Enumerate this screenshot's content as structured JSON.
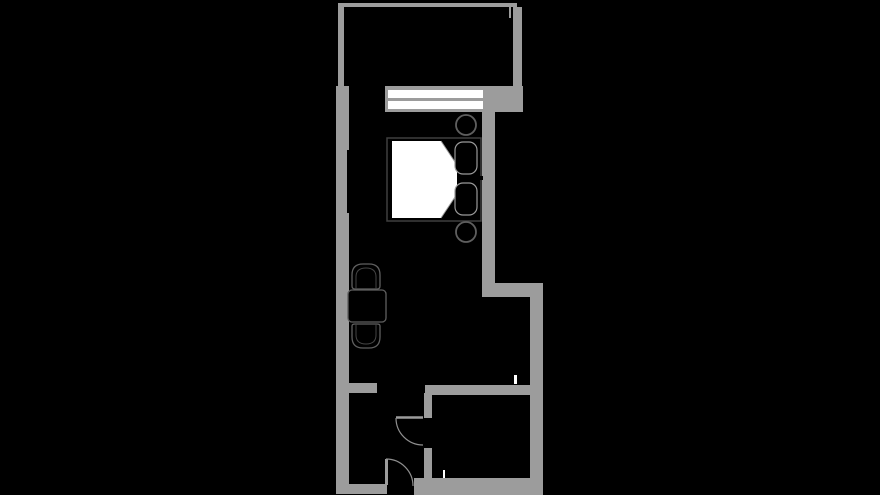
{
  "app": {
    "kind": "floor-plan-image",
    "description": "studio-apartment-floor-plan-on-black"
  },
  "colors": {
    "bg": "#000000",
    "wall": "#9c9c9c",
    "white": "#ffffff",
    "bedStroke": "#3f3f3f",
    "pillowStroke": "#9a9a9a",
    "fold": "#9a9a9a",
    "furn": "#5f5f5f",
    "furnDim": "#454545",
    "door": "#8f8f8f"
  },
  "floorplan": {
    "canvas": {
      "width": 880,
      "height": 495
    },
    "rooms": [
      {
        "name": "balcony",
        "bounds": [
          344,
          7,
          169,
          79
        ]
      },
      {
        "name": "main-room",
        "bounds": [
          349,
          112,
          133,
          271
        ]
      },
      {
        "name": "entry-hall",
        "bounds": [
          349,
          393,
          75,
          91
        ]
      },
      {
        "name": "bathroom",
        "bounds": [
          432,
          395,
          98,
          83
        ]
      }
    ],
    "elements": [
      {
        "name": "room-balcony",
        "type": "rect",
        "x": 344,
        "y": 7,
        "w": 169,
        "h": 79,
        "fill": "bg"
      },
      {
        "name": "room-main",
        "type": "rect",
        "x": 349,
        "y": 112,
        "w": 133,
        "h": 271,
        "fill": "bg"
      },
      {
        "name": "room-entry-hall",
        "type": "rect",
        "x": 349,
        "y": 393,
        "w": 75,
        "h": 91,
        "fill": "bg"
      },
      {
        "name": "room-bathroom",
        "type": "rect",
        "x": 432,
        "y": 395,
        "w": 98,
        "h": 83,
        "fill": "bg"
      },
      {
        "name": "wall-balcony-top-rail",
        "type": "rect",
        "x": 338,
        "y": 3,
        "w": 179,
        "h": 4,
        "fill": "wall"
      },
      {
        "name": "wall-left-upper",
        "type": "rect",
        "x": 338,
        "y": 7,
        "w": 6,
        "h": 79,
        "fill": "wall"
      },
      {
        "name": "wall-left-main",
        "type": "rect",
        "x": 336,
        "y": 86,
        "w": 13,
        "h": 408,
        "fill": "wall"
      },
      {
        "name": "wall-window-band",
        "type": "rect",
        "x": 385,
        "y": 86,
        "w": 138,
        "h": 26,
        "fill": "wall"
      },
      {
        "name": "wall-balcony-right",
        "type": "rect",
        "x": 513,
        "y": 7,
        "w": 9,
        "h": 105,
        "fill": "wall"
      },
      {
        "name": "wall-balcony-right-return",
        "type": "rect",
        "x": 509,
        "y": 7,
        "w": 2,
        "h": 11,
        "fill": "wall"
      },
      {
        "name": "wall-main-right",
        "type": "rect",
        "x": 482,
        "y": 110,
        "w": 13,
        "h": 187,
        "fill": "wall"
      },
      {
        "name": "wall-right-step",
        "type": "rect",
        "x": 482,
        "y": 283,
        "w": 61,
        "h": 14,
        "fill": "wall"
      },
      {
        "name": "wall-lower-right",
        "type": "rect",
        "x": 530,
        "y": 283,
        "w": 13,
        "h": 212,
        "fill": "wall"
      },
      {
        "name": "wall-bathroom-top",
        "type": "rect",
        "x": 425,
        "y": 385,
        "w": 108,
        "h": 10,
        "fill": "wall"
      },
      {
        "name": "wall-bathroom-left-upper",
        "type": "rect",
        "x": 424,
        "y": 393,
        "w": 8,
        "h": 25,
        "fill": "wall"
      },
      {
        "name": "wall-bathroom-left-lower",
        "type": "rect",
        "x": 424,
        "y": 448,
        "w": 8,
        "h": 30,
        "fill": "wall"
      },
      {
        "name": "wall-hall-stub",
        "type": "rect",
        "x": 349,
        "y": 383,
        "w": 28,
        "h": 10,
        "fill": "wall"
      },
      {
        "name": "wall-bottom-left",
        "type": "rect",
        "x": 336,
        "y": 484,
        "w": 51,
        "h": 10,
        "fill": "wall"
      },
      {
        "name": "wall-bottom-right",
        "type": "rect",
        "x": 414,
        "y": 478,
        "w": 129,
        "h": 17,
        "fill": "wall"
      },
      {
        "name": "window-glazing-outer",
        "type": "rect",
        "x": 388,
        "y": 90,
        "w": 95,
        "h": 8,
        "fill": "white"
      },
      {
        "name": "window-glazing-inner",
        "type": "rect",
        "x": 388,
        "y": 101,
        "w": 95,
        "h": 8,
        "fill": "white"
      },
      {
        "name": "wardrobe-recess",
        "type": "rect",
        "x": 347,
        "y": 150,
        "w": 3,
        "h": 63,
        "fill": "bg"
      },
      {
        "name": "bed-frame",
        "type": "rect",
        "x": 387,
        "y": 138,
        "w": 94,
        "h": 83,
        "fill": "bg",
        "stroke": "bedStroke",
        "sw": 1.5
      },
      {
        "name": "bed-mattress",
        "type": "polygon",
        "points": "392,141 441,141 457,165 457,194 441,218 392,218",
        "fill": "white"
      },
      {
        "name": "bed-sheet-fold-top",
        "type": "line",
        "x1": 441,
        "y1": 141,
        "x2": 457,
        "y2": 165,
        "stroke": "fold",
        "sw": 1
      },
      {
        "name": "bed-sheet-fold-bottom",
        "type": "line",
        "x1": 457,
        "y1": 194,
        "x2": 441,
        "y2": 218,
        "stroke": "fold",
        "sw": 1
      },
      {
        "name": "bed-pillow-top",
        "type": "rect",
        "x": 455,
        "y": 142,
        "w": 22,
        "h": 32,
        "rx": 8,
        "fill": "bg",
        "stroke": "pillowStroke",
        "sw": 1.2
      },
      {
        "name": "bed-pillow-bottom",
        "type": "rect",
        "x": 455,
        "y": 183,
        "w": 22,
        "h": 32,
        "rx": 8,
        "fill": "bg",
        "stroke": "pillowStroke",
        "sw": 1.2
      },
      {
        "name": "bed-headboard-notch",
        "type": "rect",
        "x": 479,
        "y": 176,
        "w": 4,
        "h": 4,
        "fill": "bg"
      },
      {
        "name": "nightstand-top",
        "type": "circle",
        "cx": 466,
        "cy": 125,
        "r": 10,
        "fill": "bg",
        "stroke": "furn",
        "sw": 1.8
      },
      {
        "name": "nightstand-bottom",
        "type": "circle",
        "cx": 466,
        "cy": 232,
        "r": 10,
        "fill": "bg",
        "stroke": "furn",
        "sw": 1.8
      },
      {
        "name": "chair-north",
        "type": "path",
        "d": "M352,275 Q352,264 363,264 L369,264 Q380,264 380,275 L380,286 Q380,289 377,289 L355,289 Q352,289 352,286 Z",
        "fill": "bg",
        "stroke": "furn",
        "sw": 1.3
      },
      {
        "name": "chair-north-inner",
        "type": "path",
        "d": "M356,289 L356,277 Q356,268 366,268 Q376,268 376,277 L376,289",
        "fill": "none",
        "stroke": "furnDim",
        "sw": 1
      },
      {
        "name": "dining-table",
        "type": "rect",
        "x": 348,
        "y": 290,
        "w": 38,
        "h": 32,
        "rx": 4,
        "fill": "bg",
        "stroke": "furn",
        "sw": 1.3
      },
      {
        "name": "chair-south",
        "type": "path",
        "d": "M352,326 Q352,324 355,324 L377,324 Q380,324 380,326 L380,337 Q380,348 369,348 L363,348 Q352,348 352,337 Z",
        "fill": "bg",
        "stroke": "furn",
        "sw": 1.3
      },
      {
        "name": "chair-south-inner",
        "type": "path",
        "d": "M356,324 L356,335 Q356,344 366,344 Q376,344 376,335 L376,324",
        "fill": "none",
        "stroke": "furnDim",
        "sw": 1
      },
      {
        "name": "bathroom-door-leaf",
        "type": "line",
        "x1": 396,
        "y1": 417.5,
        "x2": 423,
        "y2": 417.5,
        "stroke": "wall",
        "sw": 2.5
      },
      {
        "name": "bathroom-door-swing",
        "type": "path",
        "d": "M396,418 A27,27 0 0 0 423,445",
        "fill": "none",
        "stroke": "door",
        "sw": 1.2
      },
      {
        "name": "entrance-door-leaf",
        "type": "line",
        "x1": 386.5,
        "y1": 459,
        "x2": 386.5,
        "y2": 485,
        "stroke": "wall",
        "sw": 3
      },
      {
        "name": "entrance-door-swing",
        "type": "path",
        "d": "M386,459 A27,27 0 0 1 413,486",
        "fill": "none",
        "stroke": "door",
        "sw": 1.2
      },
      {
        "name": "marker-tick-upper",
        "type": "rect",
        "x": 514,
        "y": 375,
        "w": 3,
        "h": 9,
        "fill": "white"
      },
      {
        "name": "marker-tick-lower",
        "type": "rect",
        "x": 443,
        "y": 470,
        "w": 2,
        "h": 8,
        "fill": "white"
      }
    ]
  }
}
